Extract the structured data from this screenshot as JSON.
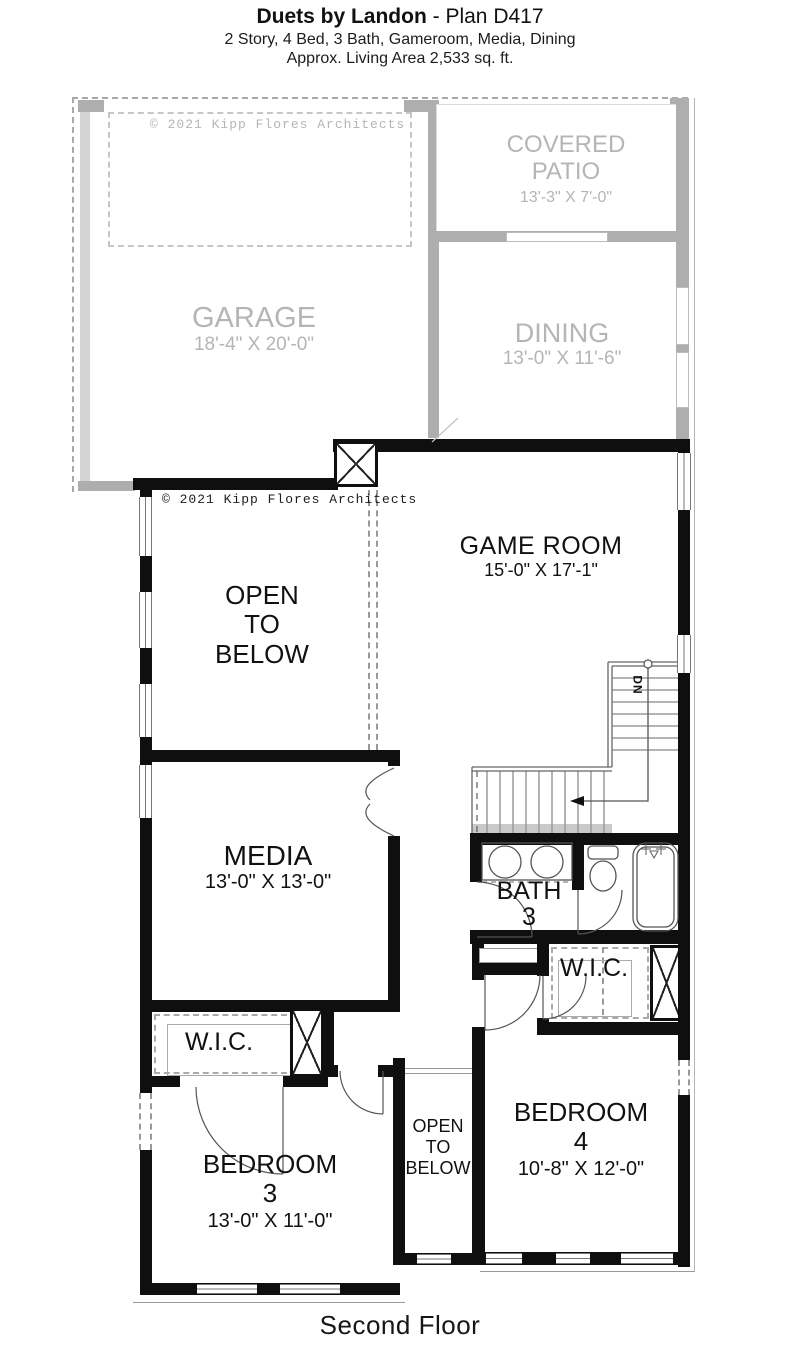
{
  "meta": {
    "floor_label": "Second Floor"
  },
  "header": {
    "title_bold": "Duets by Landon",
    "title_rest": " - Plan D417",
    "subtitle": "2 Story, 4 Bed, 3 Bath, Gameroom, Media, Dining",
    "area_line": "Approx. Living Area 2,533 sq. ft."
  },
  "copyright": {
    "ghost": "© 2021 Kipp Flores Architects",
    "main": "© 2021 Kipp Flores Architects"
  },
  "rooms": {
    "garage": {
      "name": "GARAGE",
      "dims": "18'-4\" X 20'-0\""
    },
    "covered_patio": {
      "line1": "COVERED",
      "line2": "PATIO",
      "dims": "13'-3\" X 7'-0\""
    },
    "dining": {
      "name": "DINING",
      "dims": "13'-0\" X 11'-6\""
    },
    "game_room": {
      "name": "GAME ROOM",
      "dims": "15'-0\" X 17'-1\""
    },
    "open_below_large": {
      "line1": "OPEN",
      "line2": "TO",
      "line3": "BELOW"
    },
    "open_below_small": {
      "line1": "OPEN",
      "line2": "TO",
      "line3": "BELOW"
    },
    "media": {
      "name": "MEDIA",
      "dims": "13'-0\" X 13'-0\""
    },
    "bath3": {
      "line1": "BATH",
      "line2": "3"
    },
    "wic_left": {
      "name": "W.I.C."
    },
    "wic_right": {
      "name": "W.I.C."
    },
    "bedroom3": {
      "line1": "BEDROOM",
      "line2": "3",
      "dims": "13'-0\" X 11'-0\""
    },
    "bedroom4": {
      "line1": "BEDROOM",
      "line2": "4",
      "dims": "10'-8\" X 12'-0\""
    }
  },
  "stairs": {
    "down_label": "DN"
  },
  "colors": {
    "wall": "#0f0f0f",
    "ghost_wall": "#aeaeae",
    "ghost_text": "#b5b5b5",
    "text": "#111111",
    "line": "#999999"
  }
}
